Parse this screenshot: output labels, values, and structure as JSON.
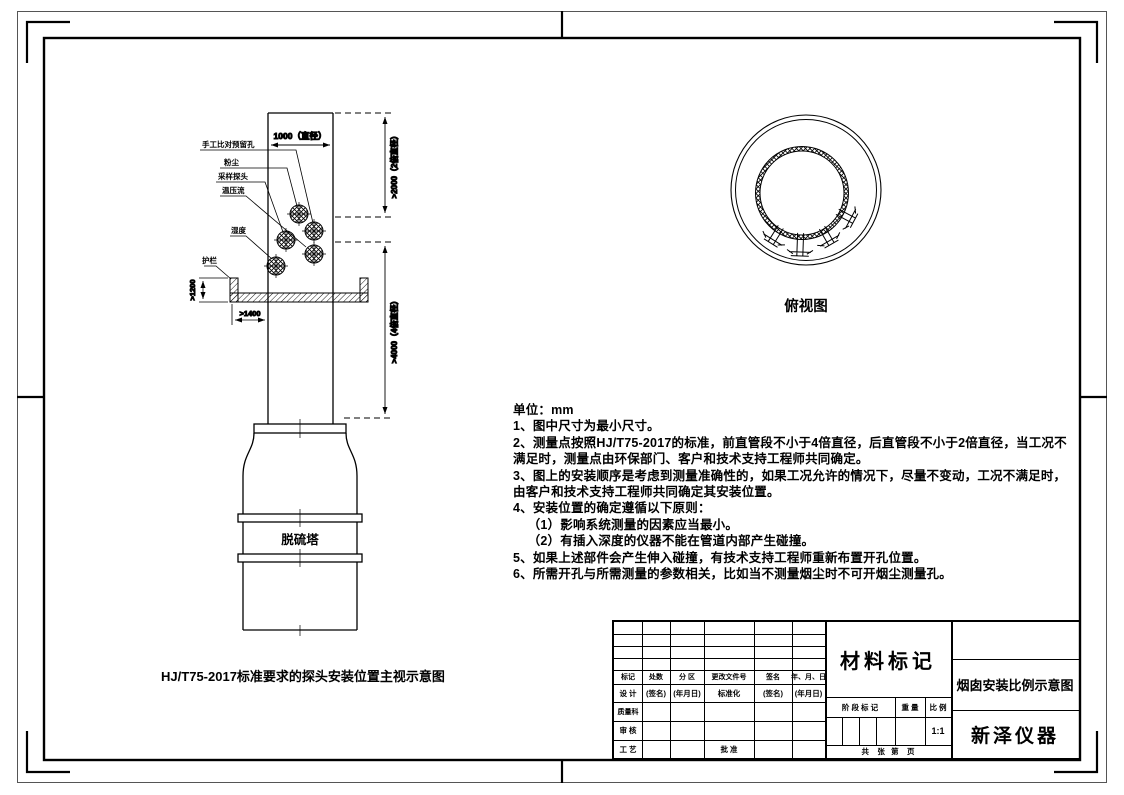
{
  "front_view": {
    "caption": "HJ/T75-2017标准要求的探头安装位置主视示意图",
    "tower_label": "脱硫塔",
    "port_labels": {
      "manual_hole": "手工比对预留孔",
      "dust": "粉尘",
      "probe": "采样探头",
      "temp_press_flow": "温压流",
      "humidity": "湿度",
      "guardrail": "护栏"
    },
    "dimensions": {
      "diameter": "1000（直径）",
      "upstream": ">2000（2倍直径）",
      "downstream": ">4000（4倍直径）",
      "rail_height": ">1200",
      "platform_width": ">1400"
    }
  },
  "top_view": {
    "caption": "俯视图"
  },
  "notes": {
    "lines": [
      "单位：mm",
      "1、图中尺寸为最小尺寸。",
      "2、测量点按照HJ/T75-2017的标准，前直管段不小于4倍直径，后直管段不小于2倍直径，当工况不",
      "满足时，测量点由环保部门、客户和技术支持工程师共同确定。",
      "3、图上的安装顺序是考虑到测量准确性的，如果工况允许的情况下，尽量不变动，工况不满足时，",
      "由客户和技术支持工程师共同确定其安装位置。",
      "4、安装位置的确定遵循以下原则：",
      "    （1）影响系统测量的因素应当最小。",
      "    （2）有插入深度的仪器不能在管道内部产生碰撞。",
      "5、如果上述部件会产生伸入碰撞，有技术支持工程师重新布置开孔位置。",
      "6、所需开孔与所需测量的参数相关，比如当不测量烟尘时不可开烟尘测量孔。"
    ]
  },
  "title_block": {
    "material_mark": "材料标记",
    "drawing_title": "烟囱安装比例示意图",
    "company": "新泽仪器",
    "scale_value": "1:1",
    "pages_row": "共    张   第    页",
    "stage_row": {
      "stage": "阶 段 标 记",
      "weight": "重 量",
      "scale": "比 例"
    },
    "rev_header": {
      "mark": "标记",
      "count": "处数",
      "zone": "分 区",
      "doc": "更改文件号",
      "sign": "签名",
      "date": "年、月、日"
    },
    "design_row": {
      "c1": "设 计",
      "c2": "(签名)",
      "c3": "(年月日)",
      "c4": "标准化",
      "c5": "(签名)",
      "c6": "(年月日)"
    },
    "dept": "质量科",
    "check": "审 核",
    "craft": "工 艺",
    "approve": "批 准"
  }
}
